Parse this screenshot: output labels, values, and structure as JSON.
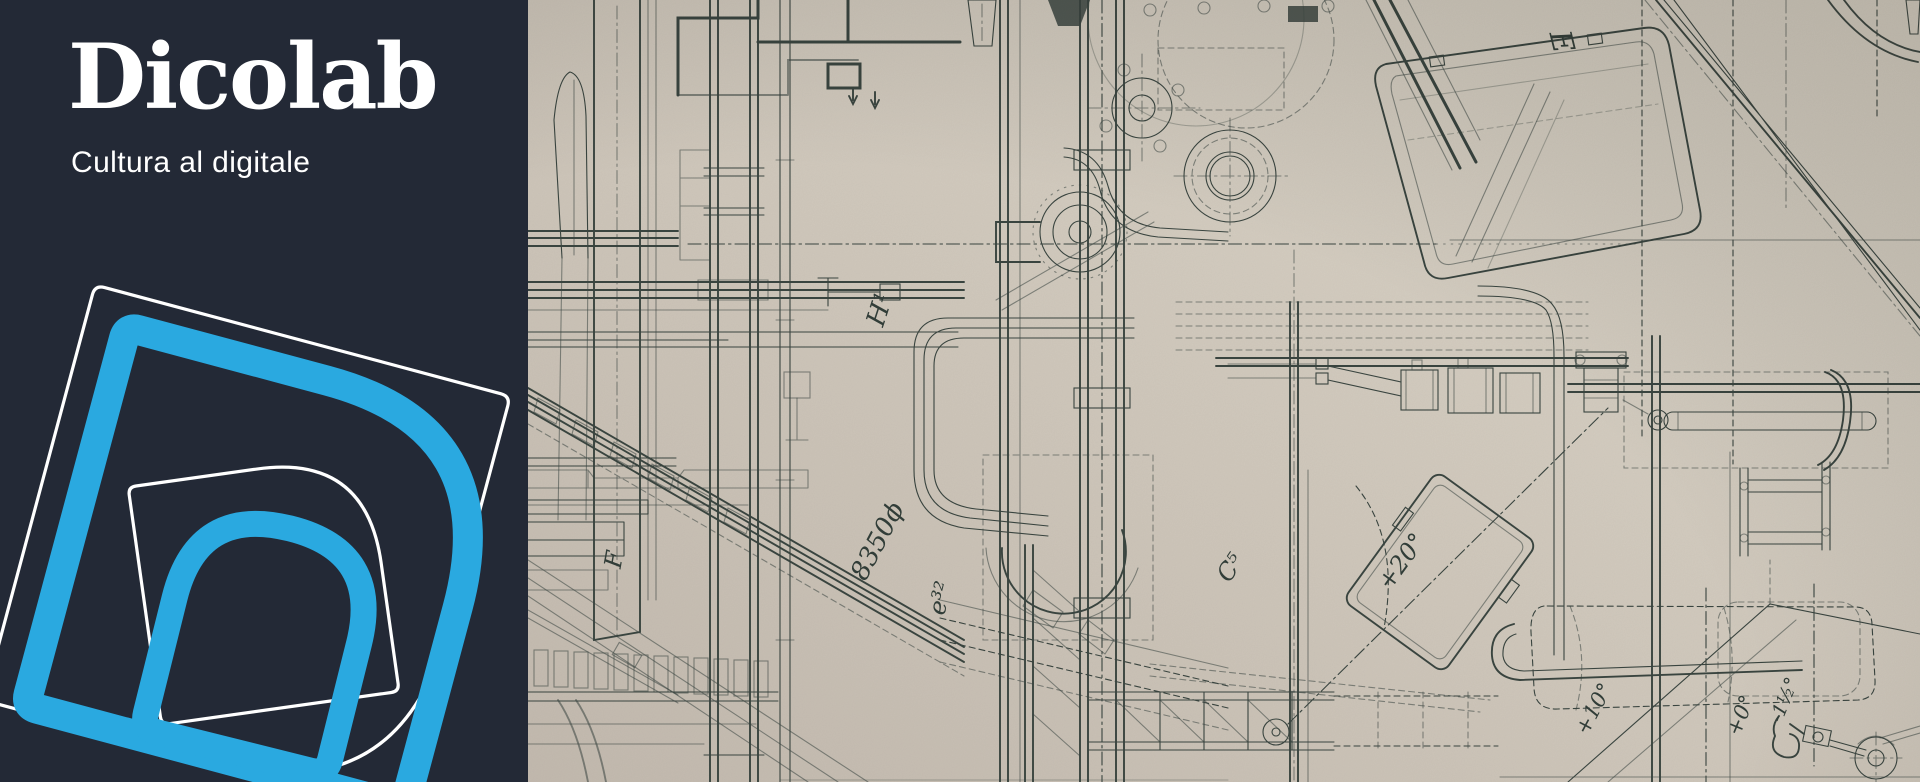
{
  "brand": {
    "name": "Dicolab",
    "tagline": "Cultura al digitale",
    "mark": "dicolab-d-monogram-outlines",
    "colors": {
      "panel_background": "#232936",
      "accent_blue": "#2aa9e0",
      "logo_white": "#ffffff"
    }
  },
  "artwork": {
    "description": "Vintage engineering technical drawing of industrial machinery photographed on aged beige paper",
    "colors": {
      "paper": "#cfc7bb",
      "ink": "#39443f"
    },
    "labels": [
      {
        "id": "E",
        "text": "E"
      },
      {
        "id": "H1",
        "text": "H¹"
      },
      {
        "id": "F",
        "text": "F"
      },
      {
        "id": "diam",
        "text": "8350ϕ"
      },
      {
        "id": "e32",
        "text": "e³²"
      },
      {
        "id": "C5",
        "text": "C⁵"
      },
      {
        "id": "plus20",
        "text": "+20°"
      },
      {
        "id": "plus10",
        "text": "+10°"
      },
      {
        "id": "plus0",
        "text": "+0°"
      },
      {
        "id": "mhalf",
        "text": "-1½°"
      }
    ]
  }
}
